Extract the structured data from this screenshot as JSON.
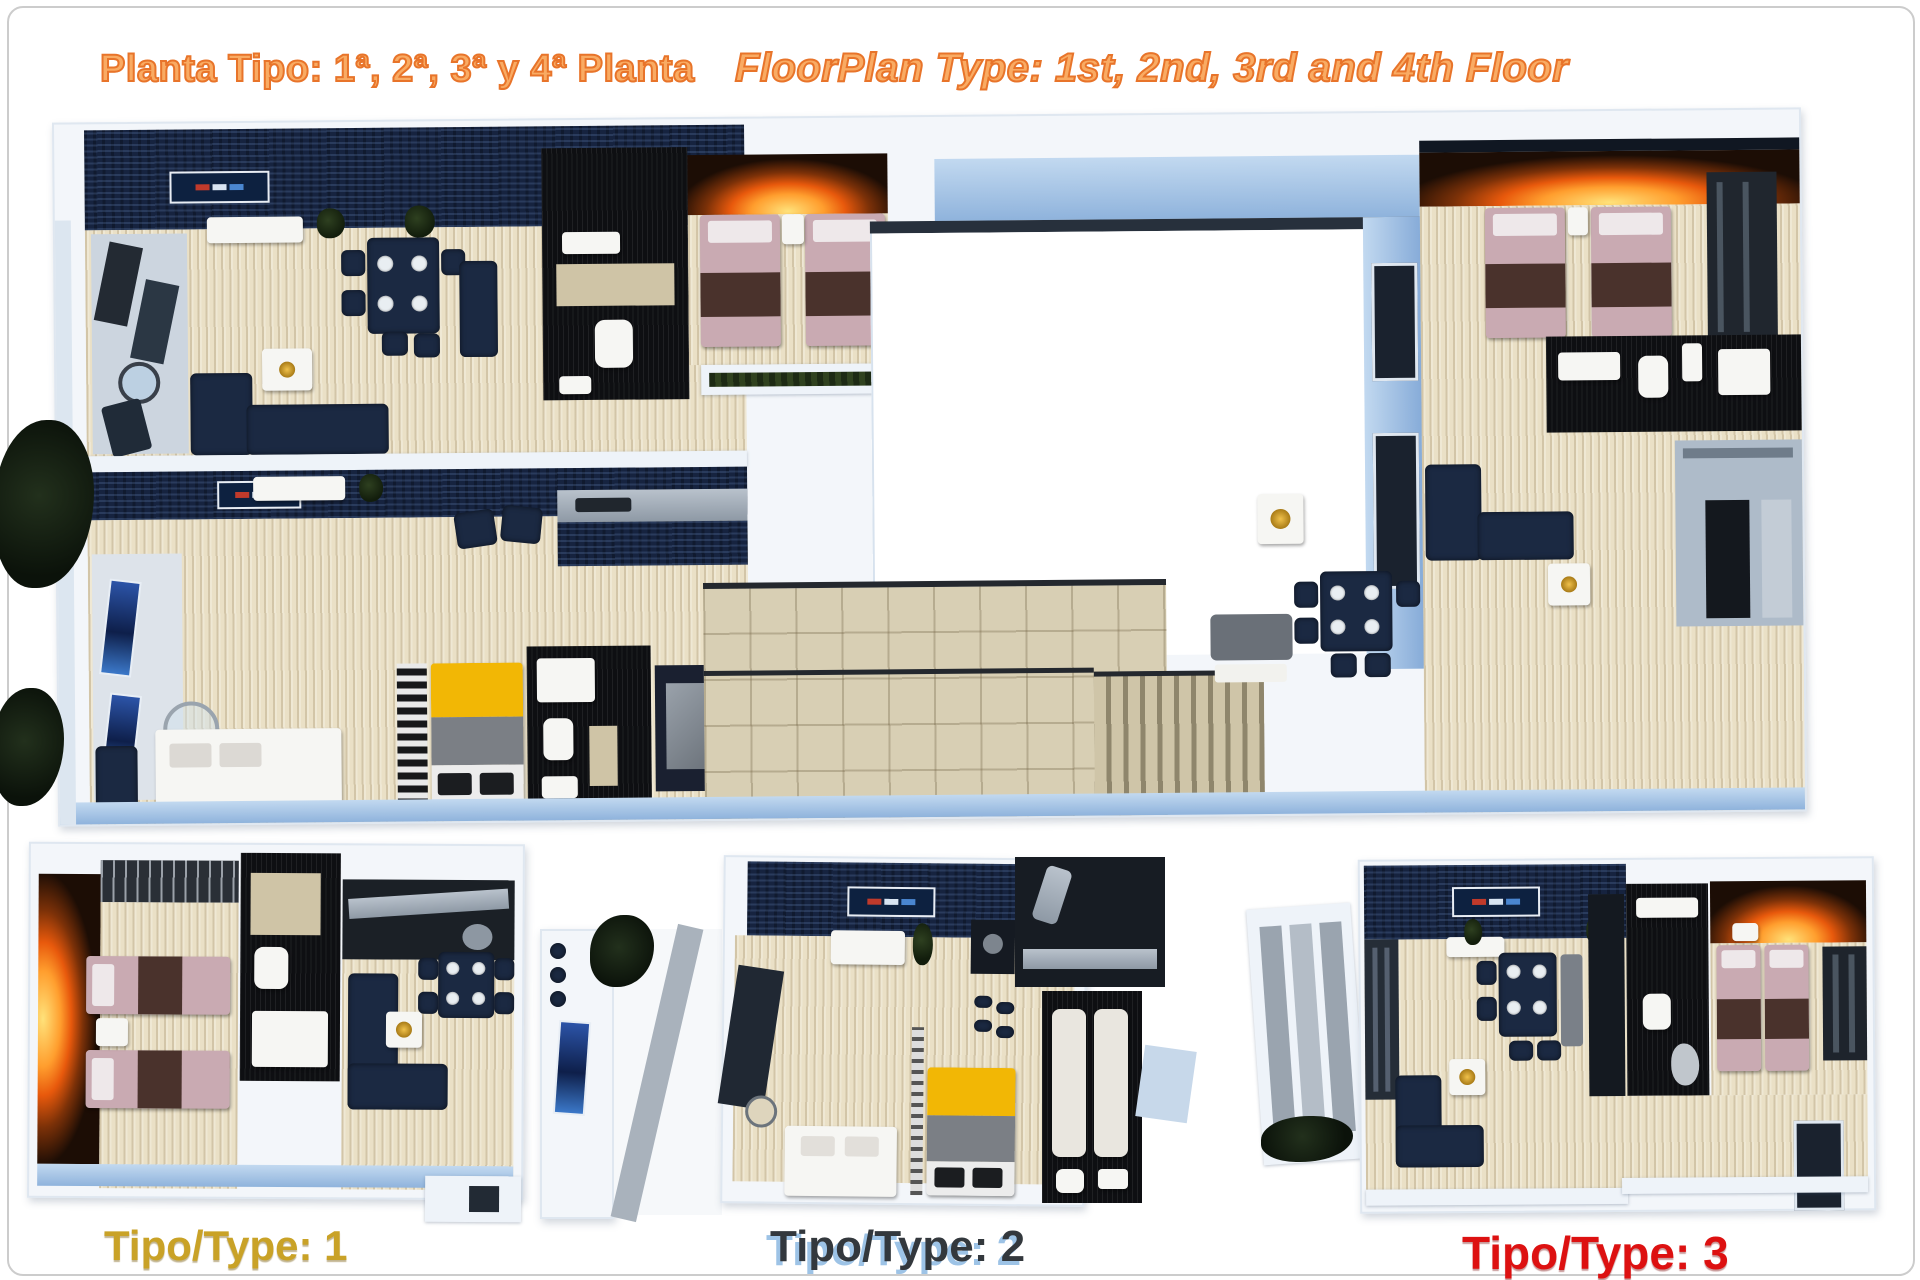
{
  "header": {
    "title_es": "Planta Tipo: 1ª, 2ª, 3ª y 4ª Planta",
    "title_en": "FloorPlan Type: 1st, 2nd, 3rd and 4th Floor",
    "title_outline_color": "#E8742A",
    "title_fill_color": "#F9AB63"
  },
  "plans": {
    "type1": {
      "label": "Tipo/Type: 1",
      "label_color": "#C9A227"
    },
    "type2": {
      "label": "Tipo/Type: 2",
      "label_color": "#33383D",
      "label_shadow_color": "#9DC3E6"
    },
    "type3": {
      "label": "Tipo/Type: 3",
      "label_color": "#DD1111"
    }
  },
  "palette": {
    "wall_blue": "#8FB3DC",
    "wall_white": "#EEF3F9",
    "floor_beige": "#EAE0C6",
    "ceiling_navy": "#16233F",
    "bathroom_black": "#0E0F12",
    "furniture_navy": "#1B2942",
    "bed_pink": "#C9AAB2",
    "bed_yellow": "#F2B705",
    "fire_glow_orange": "#FF9E2E",
    "page_border_gray": "#CCCCCC"
  }
}
